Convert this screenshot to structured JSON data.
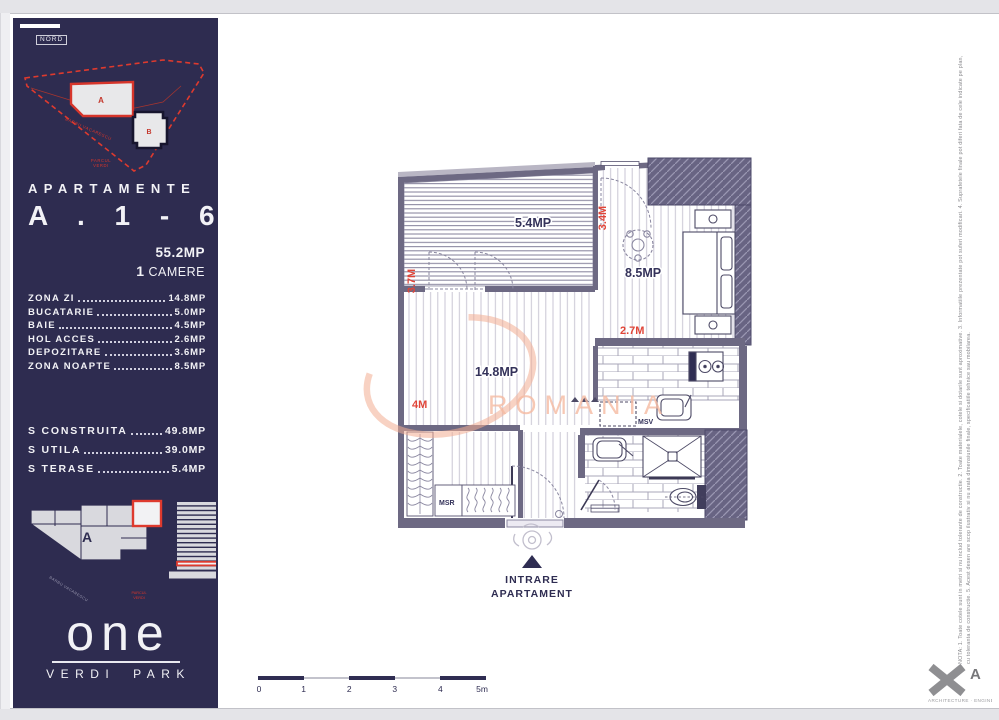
{
  "colors": {
    "navy": "#2e2c50",
    "red": "#de3a2e",
    "wall": "#6d6983",
    "salmon": "#f3ad92",
    "label": "#34325a"
  },
  "sidebar": {
    "nord": "NORD",
    "siteplan": {
      "a": "A",
      "b": "B",
      "street": "BARBU VACARESCU",
      "park_l1": "PARCUL",
      "park_l2": "VERDI"
    },
    "heading_small": "APARTAMENTE",
    "heading_big": "A . 1 - 6",
    "total_area": "55.2MP",
    "rooms_count": "1",
    "rooms_word": "CAMERE",
    "rooms": [
      {
        "name": "ZONA ZI",
        "value": "14.8MP"
      },
      {
        "name": "BUCATARIE",
        "value": "5.0MP"
      },
      {
        "name": "BAIE",
        "value": "4.5MP"
      },
      {
        "name": "HOL ACCES",
        "value": "2.6MP"
      },
      {
        "name": "DEPOZITARE",
        "value": "3.6MP"
      },
      {
        "name": "ZONA NOAPTE",
        "value": "8.5MP"
      }
    ],
    "surfaces": [
      {
        "name": "S CONSTRUITA",
        "value": "49.8MP"
      },
      {
        "name": "S UTILA",
        "value": "39.0MP"
      },
      {
        "name": "S TERASE",
        "value": "5.4MP"
      }
    ],
    "keyplan": {
      "building": "A",
      "street": "BARBU VACARESCU",
      "park_l1": "PARCUL",
      "park_l2": "VERDI"
    },
    "brand": {
      "name": "one",
      "sub": "VERDI PARK"
    }
  },
  "plan": {
    "terrace_area": "5.4MP",
    "living_area": "14.8MP",
    "bedroom_area": "8.5MP",
    "dim_left": "3.7M",
    "dim_top": "3.4M",
    "dim_mid": "2.7M",
    "dim_bottom": "4M",
    "msv": "MSV",
    "msr": "MSR",
    "entrance_l1": "INTRARE",
    "entrance_l2": "APARTAMENT",
    "watermark": "ROMANIA"
  },
  "scalebar": {
    "labels": [
      "0",
      "1",
      "2",
      "3",
      "4",
      "5m"
    ]
  },
  "footer": {
    "note_l1": "NOTA: 1. Toate cotele sunt in metri si nu includ tolerante de constructie. 2. Toate materialele, cotele si dotarile sunt aproximative. 3. Informatiile prezentate pot suferi modificari.",
    "note_l2": "4. Suprafetele finale pot diferi fata de cele indicate pe plan, cu toleranta de constructie. 5. Acest desen are scop ilustrativ si nu arata dimensiunile finale, specificatiile tehnice sau mobilarea.",
    "logo_letter": "A",
    "logo_caption": "ARCHITECTURE · ENGINEERING"
  }
}
